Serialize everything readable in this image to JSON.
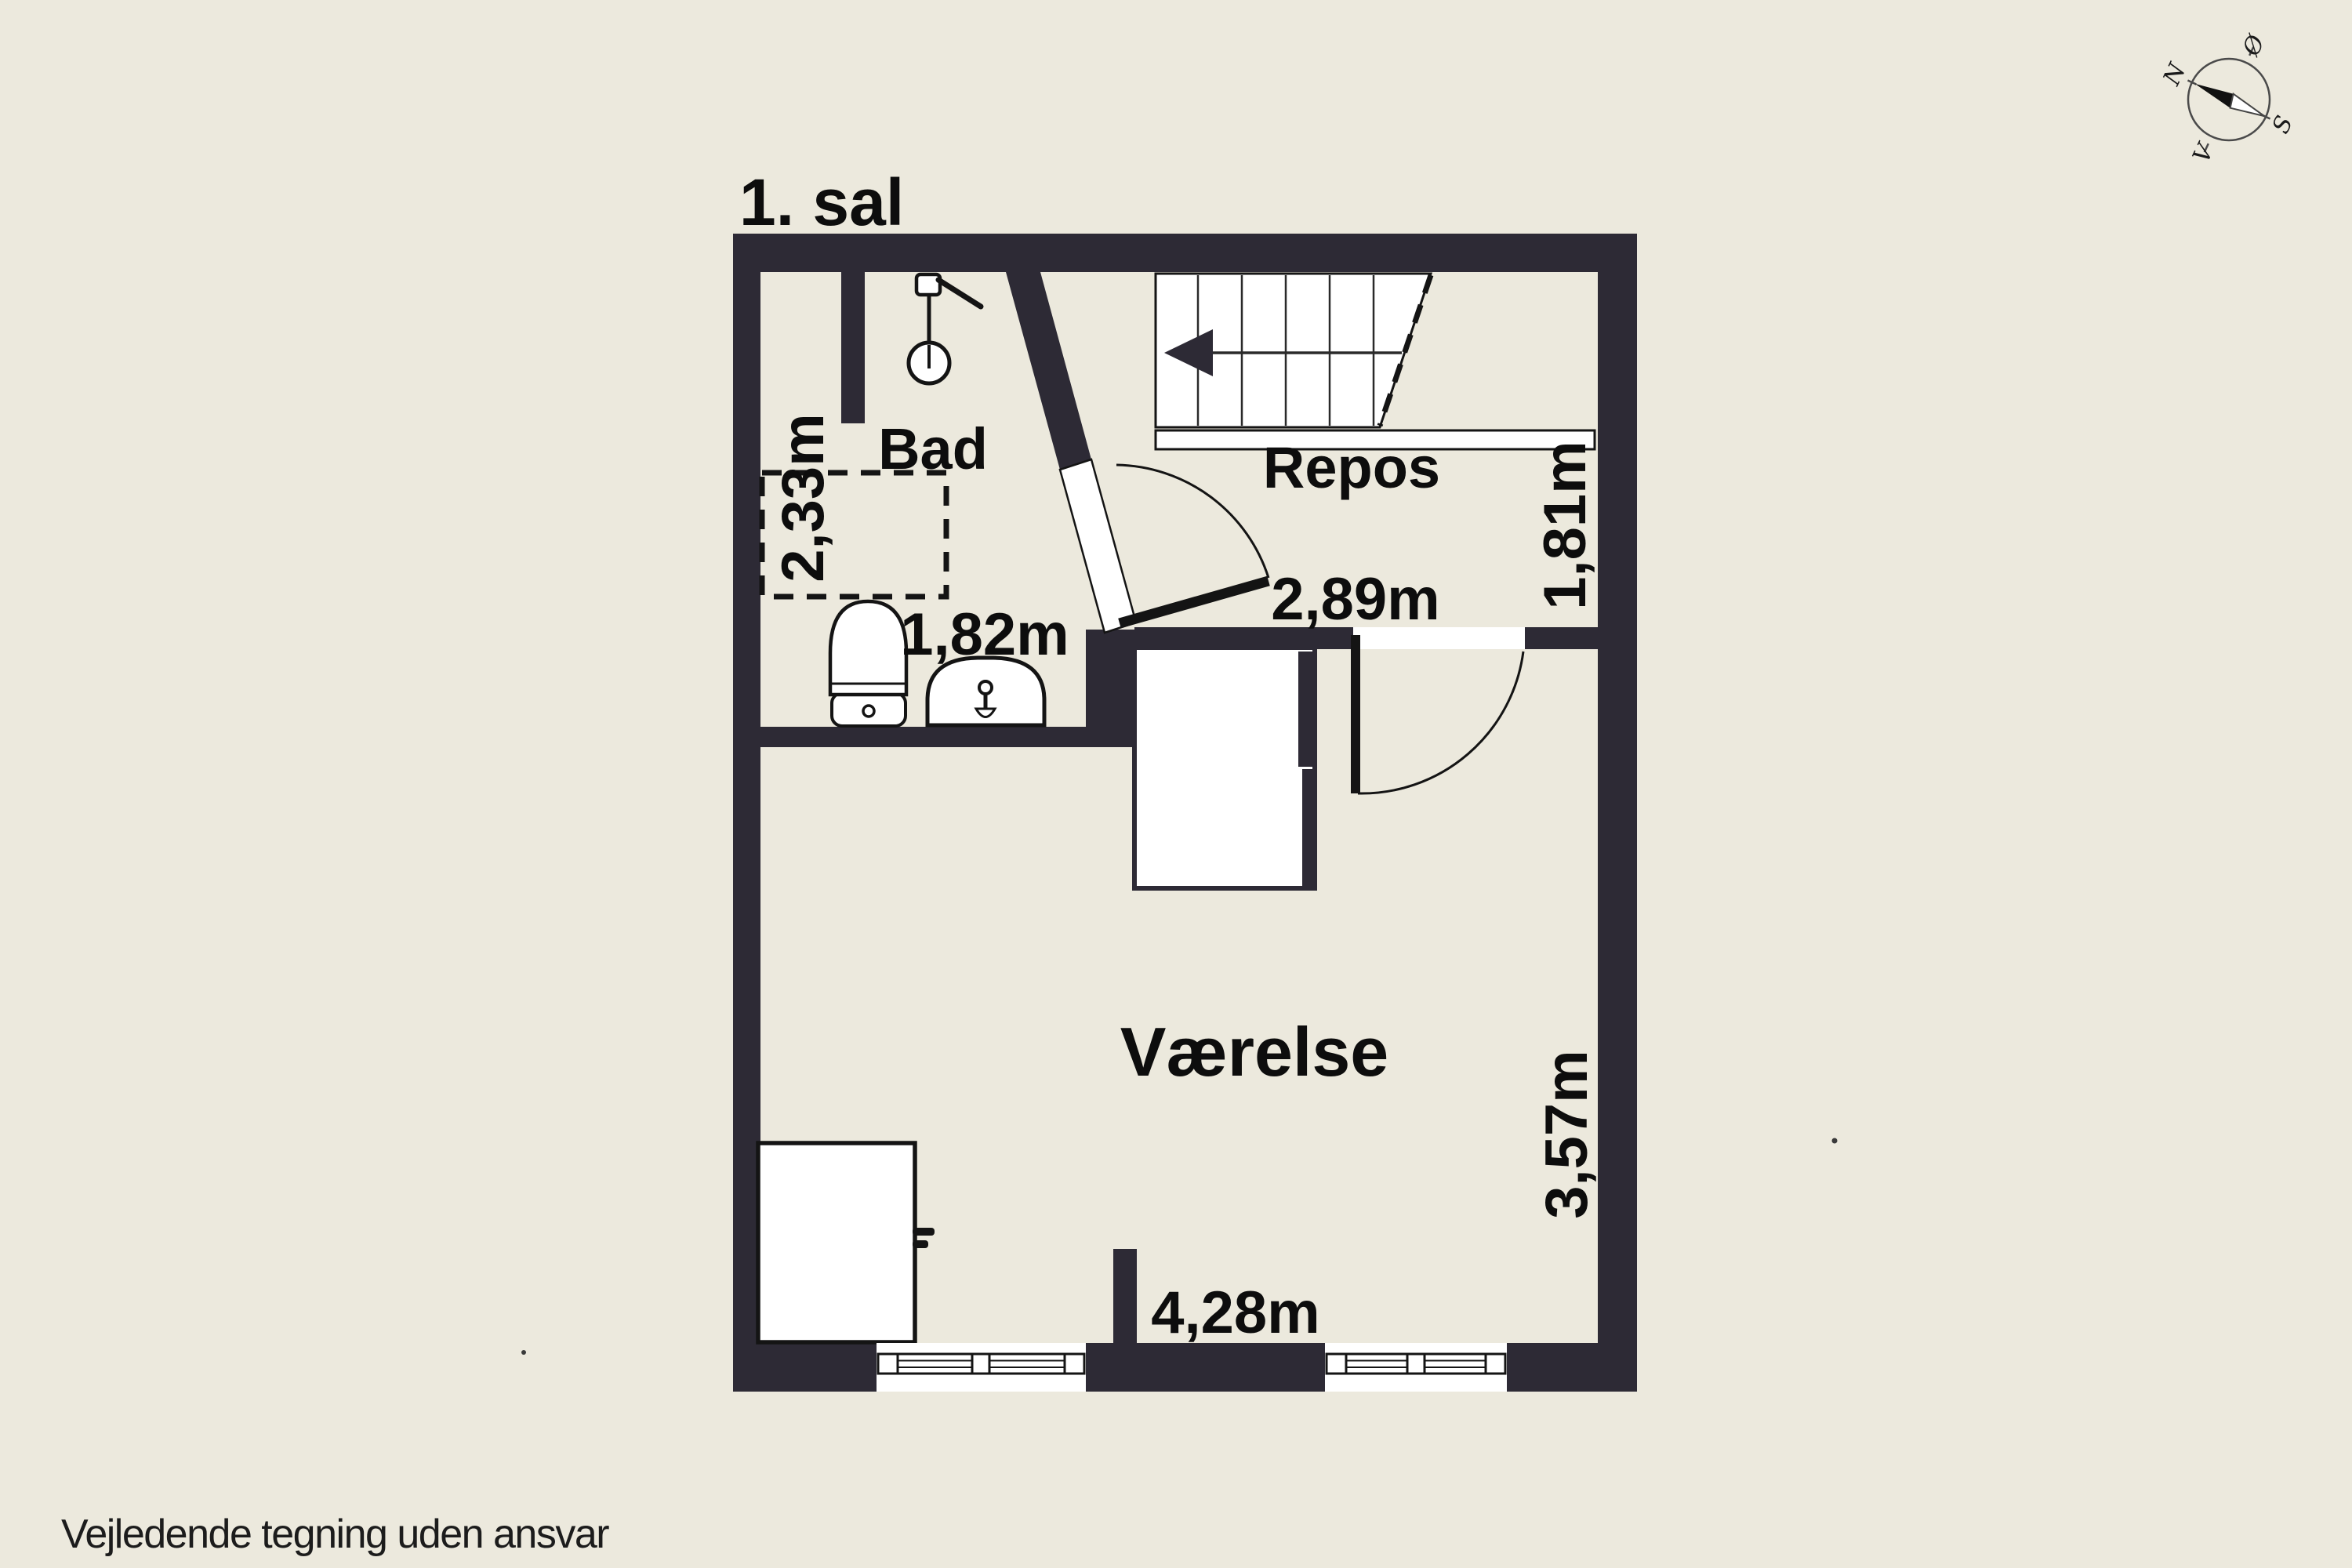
{
  "page": {
    "title": "1. sal",
    "footer": "Vejledende tegning uden ansvar"
  },
  "rooms": {
    "bathroom": {
      "name": "Bad",
      "width": "2,33m",
      "depth": "1,82m"
    },
    "landing": {
      "name": "Repos",
      "width": "2,89m",
      "depth": "1,81m"
    },
    "bedroom": {
      "name": "Værelse",
      "width": "4,28m",
      "depth": "3,57m"
    }
  },
  "compass": {
    "north": "N",
    "east": "Ø",
    "south": "S",
    "west": "V"
  },
  "colors": {
    "background": "#ECE9DD",
    "wall": "#2D2A35",
    "line": "#141414",
    "text": "#0D0D0D"
  }
}
